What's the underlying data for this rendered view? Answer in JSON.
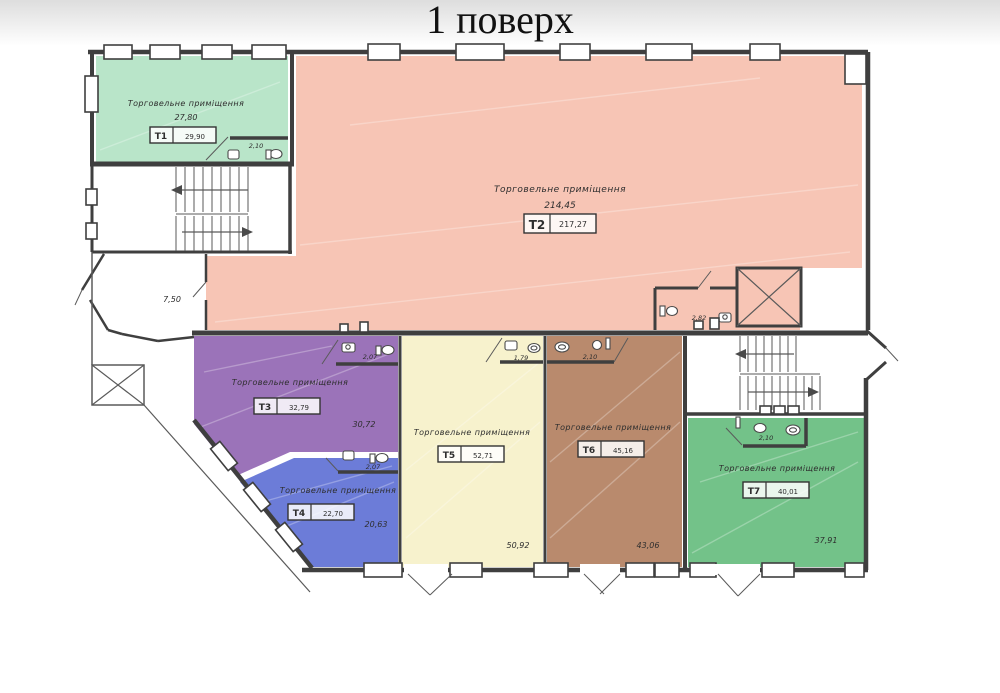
{
  "title": "1 поверх",
  "rooms": {
    "t1": {
      "code": "T1",
      "name": "Торговельне приміщення",
      "floor_area": "27,80",
      "total_area": "29,90",
      "wc_area": "2,10",
      "color": "#b9e5c9"
    },
    "t2": {
      "code": "T2",
      "name": "Торговельне приміщення",
      "floor_area": "214,45",
      "total_area": "217,27",
      "wc_area": "2,82",
      "color": "#f7c5b5"
    },
    "t3": {
      "code": "T3",
      "name": "Торговельне приміщення",
      "floor_area": "30,72",
      "total_area": "32,79",
      "wc_area": "2,07",
      "color": "#9b73b9"
    },
    "t4": {
      "code": "T4",
      "name": "Торговельне приміщення",
      "floor_area": "20,63",
      "total_area": "22,70",
      "wc_area": "2,07",
      "color": "#6c7cd8"
    },
    "t5": {
      "code": "T5",
      "name": "Торговельне приміщення",
      "floor_area": "50,92",
      "total_area": "52,71",
      "wc_area": "1,79",
      "color": "#f7f2cd"
    },
    "t6": {
      "code": "T6",
      "name": "Торговельне приміщення",
      "floor_area": "43,06",
      "total_area": "45,16",
      "wc_area": "2,10",
      "color": "#b98a6d"
    },
    "t7": {
      "code": "T7",
      "name": "Торговельне приміщення",
      "floor_area": "37,91",
      "total_area": "40,01",
      "wc_area": "2,10",
      "color": "#73c289"
    }
  },
  "annotations": {
    "vestibule_area": "7,50"
  }
}
